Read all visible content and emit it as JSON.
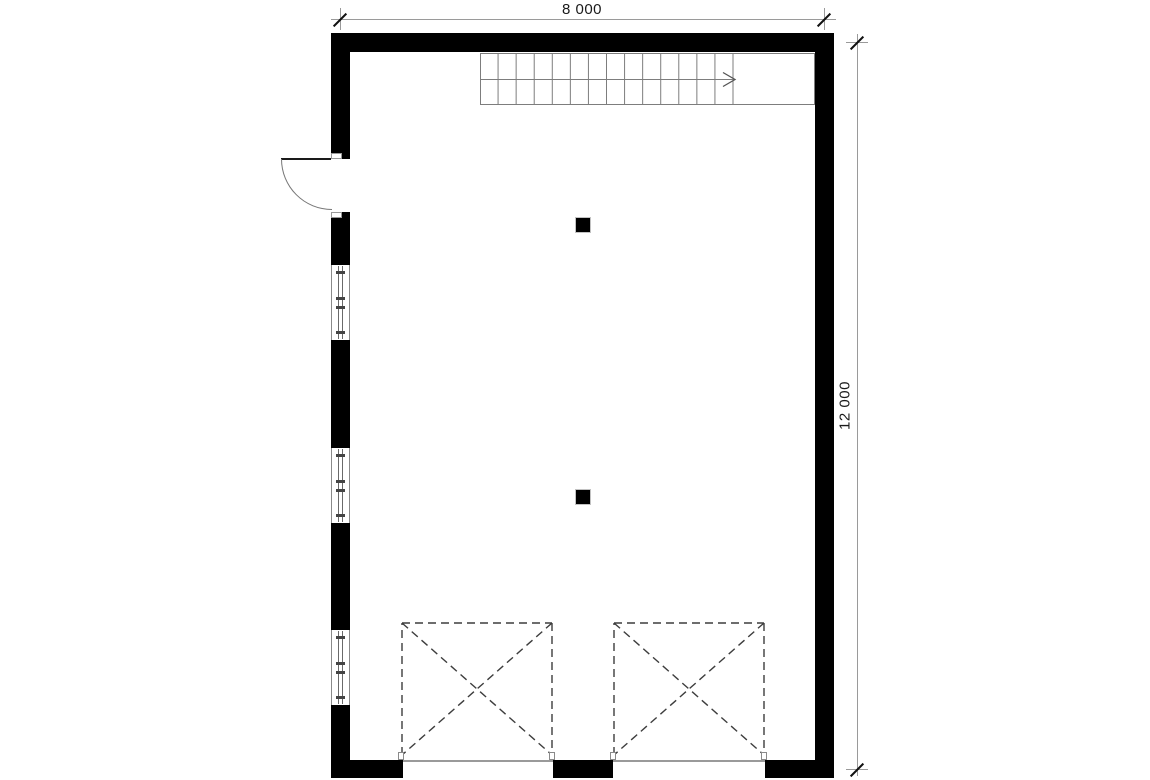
{
  "dimensions": {
    "top": {
      "label": "8 000"
    },
    "right": {
      "label": "12 000"
    }
  },
  "plan": {
    "stairs": {
      "tread_count": 14,
      "direction": "right"
    },
    "entry_door": {
      "type": "single-swing",
      "hinge": "top",
      "swing": "outward"
    },
    "windows": [
      "window-1",
      "window-2",
      "window-3"
    ],
    "columns": [
      "column-1",
      "column-2"
    ],
    "garage_doors": [
      "garage-door-1",
      "garage-door-2"
    ]
  },
  "colors": {
    "wall": "#000000",
    "thin_line": "#8a8a8a",
    "stair_line": "#7d7d7d",
    "dashed_line": "#3d3d3d",
    "dimension_line": "#9a9a9a",
    "tick": "#111111",
    "text": "#1a1a1a",
    "background": "#ffffff"
  }
}
